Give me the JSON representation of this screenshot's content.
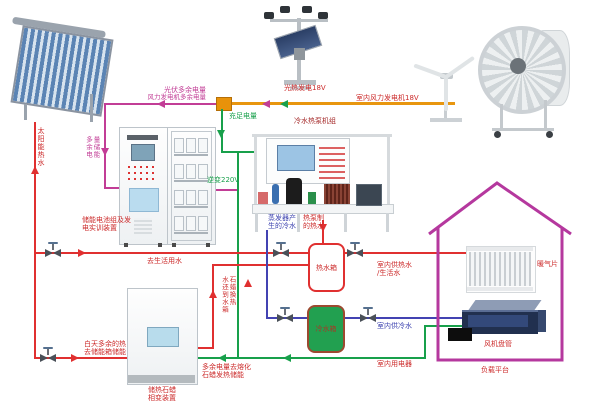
{
  "colors": {
    "wire_surplus": "#c23d96",
    "wire_charge": "#18a04b",
    "wire_gen": "#e8960f",
    "pipe_hot": "#e03030",
    "pipe_cold": "#4343b2",
    "house_outline": "#b5389e",
    "tank_cold_fill": "#22a050",
    "label_red": "#cc2b2b"
  },
  "labels": {
    "pv_surplus": "光伏多余电量",
    "wind_surplus": "风力发电机多余电量",
    "solar_thermal_gen": "光热发电18V",
    "indoor_wind_gen": "室内风力发电机18V",
    "sufficient_power": "充足电量",
    "heat_pump_title": "冷水热泵机组",
    "inverter": "逆变220V",
    "battery_device_line1": "储能电池组及发",
    "battery_device_line2": "电实训装置",
    "to_domestic_water": "去生活用水",
    "evap_cold_line1": "蒸发器产",
    "evap_cold_line2": "生的冷水",
    "hp_hot_line1": "热泵制",
    "hp_hot_line2": "的热水",
    "hot_tank": "热水箱",
    "cold_tank": "冷水箱",
    "indoor_hot_line1": "室内供热水",
    "indoor_hot_line2": "/生活水",
    "indoor_cold": "室内供冷水",
    "indoor_appliance": "室内用电器",
    "day_surplus_line1": "白天多余的热",
    "day_surplus_line2": "去储能箱储能",
    "paraffin_device_line1": "储热石蜡",
    "paraffin_device_line2": "相变装置",
    "surplus_to_paraffin_line1": "多余电量去熔化",
    "surplus_to_paraffin_line2": "石蜡发热储能",
    "radiator": "暖气片",
    "fan_coil": "风机盘管",
    "load_platform": "负载平台"
  },
  "vertical_labels": {
    "solar_hot_water": "太阳能热水",
    "surplus_storage_left": "多余电",
    "surplus_storage_right": "量储能",
    "paraffin_return_left": "水还到水箱",
    "paraffin_return_right": "石蜡换热"
  }
}
